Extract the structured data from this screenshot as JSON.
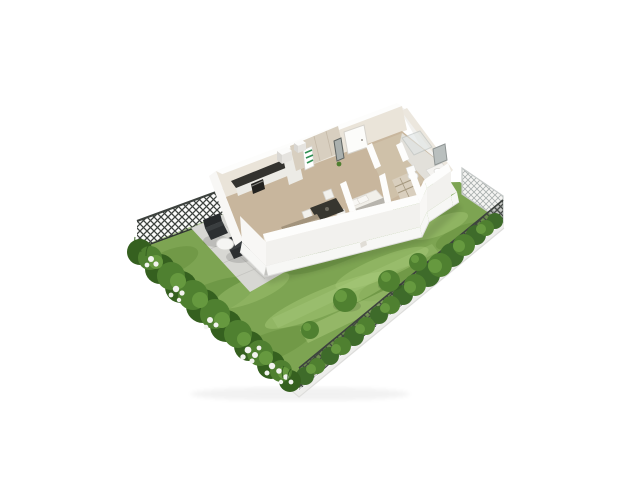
{
  "scene": {
    "type": "3d-floor-plan-render",
    "view": "isometric cutaway dollhouse view of a one-bedroom apartment with private garden",
    "apartment": {
      "rooms": [
        {
          "name": "open kitchen and living room"
        },
        {
          "name": "bedroom"
        },
        {
          "name": "entrance hall"
        },
        {
          "name": "bathroom"
        }
      ],
      "furnishings": [
        "kitchen counter with dark worktop and oven",
        "tall kitchen cabinet",
        "built-in wardrobe along back wall",
        "framed green artwork in wall niche",
        "dark dining table with four white chairs",
        "taupe sofa with cushions",
        "potted plant",
        "double bed with grey blanket and pillows",
        "hall shelving unit",
        "white entrance door",
        "hall mirror",
        "glass shower enclosure",
        "toilet",
        "washbasin vanity with mirror",
        "two roof vent blocks"
      ]
    },
    "outdoor": {
      "terrace": [
        "paved patio",
        "two dark lounge chairs",
        "round white side table"
      ],
      "garden": [
        "lawn with mowed stripes",
        "flowering shrub border with white blossoms",
        "hedge row along front fence",
        "scattered bushes"
      ],
      "fencing": [
        "dark lattice fence back-left",
        "dark mesh fence front-right",
        "light mesh fence panel right side"
      ]
    }
  },
  "colors": {
    "background": "#ffffff",
    "slab_edge": "#ededeb",
    "grass_base": "#7da452",
    "grass_dark": "#5e8a38",
    "grass_light": "#a6c776",
    "mowed_light": "#b4d286",
    "hedge_dark": "#3e6b2a",
    "hedge_mid": "#4f8030",
    "hedge_light": "#66993f",
    "shrub_dark": "#35601f",
    "flower_white": "#f2f3ef",
    "fence_dark": "#3d423e",
    "mesh_panel": "#f4f4f2",
    "paving": "#d7d7d3",
    "chair_dark": "#2c2f31",
    "chair_back": "#26292b",
    "side_table": "#f5f5f3",
    "slab": "#f7f7f5",
    "wall_top": "#fdfdfc",
    "wall_outer_bright": "#f8f7f5",
    "wall_outer": "#f2f1ee",
    "wall_inner": "#eae4d9",
    "wall_inner_light": "#ece7de",
    "floor_main": "#c8b69d",
    "floor_hall": "#cfc1a9",
    "floor_bath": "#e2e0da",
    "counter": "#34332f",
    "cabinet": "#ecebe6",
    "wardrobe": "#d8cfc0",
    "oven": "#23221f",
    "sofa": "#b3a48d",
    "sofa_back": "#a2937c",
    "sofa_cushion": "#c9bba6",
    "table_dark": "#37362f",
    "chair_white": "#f2f1ed",
    "bed": "#f1efe9",
    "blanket": "#b7b4ad",
    "pillow": "#f8f7f4",
    "shelf": "#d9cfbe",
    "art_green": "#2f8f52",
    "door": "#fcfcfa",
    "mirror": "#b9bfbe",
    "hall_mirror": "#aab0ae",
    "shower_glass": "#dfe4e4"
  }
}
